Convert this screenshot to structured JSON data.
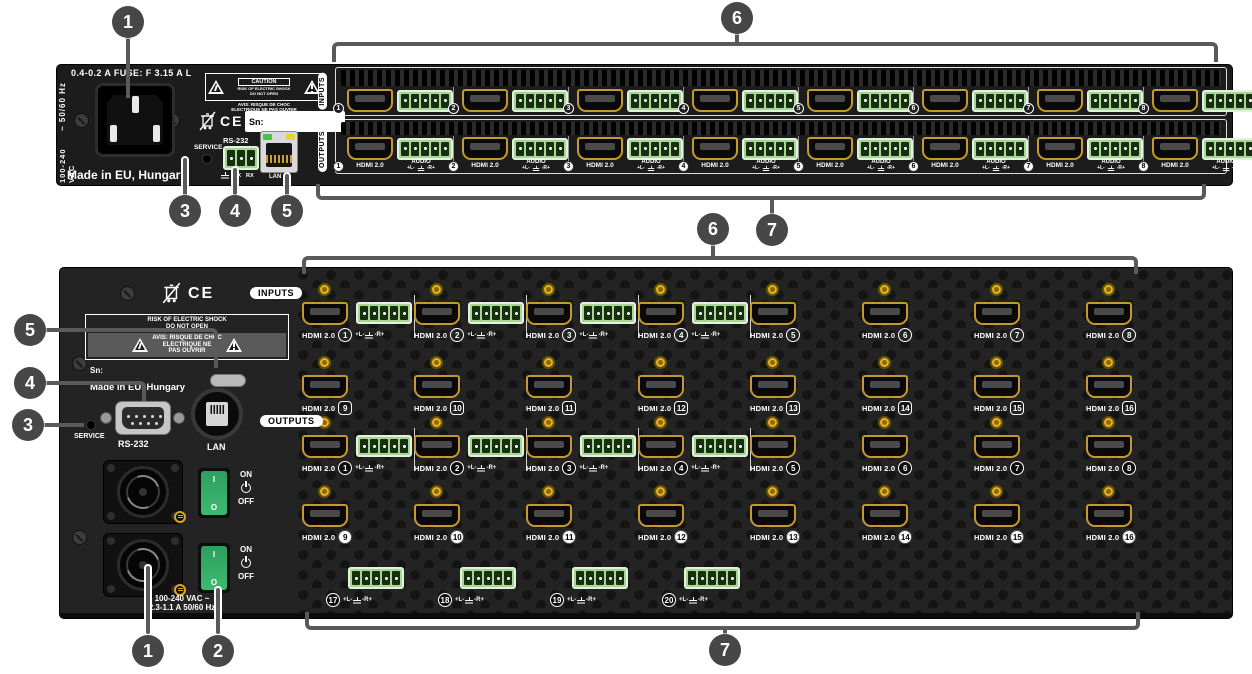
{
  "callouts": {
    "c1": "1",
    "c2": "2",
    "c3": "3",
    "c4": "4",
    "c5": "5",
    "c6": "6",
    "c7": "7"
  },
  "io": {
    "hdmi_label": "HDMI 2.0",
    "audio_label": "AUDIO",
    "pin_left": "+L-",
    "pin_right": "-R+"
  },
  "top_device": {
    "fuse_text": "0.4-0.2 A    FUSE: F 3.15 A L",
    "freq_text": "~ 50/60 Hz",
    "voltage_text": "100-240 VAC",
    "made_in_text": "Made in EU, Hungary",
    "caution_title": "CAUTION",
    "caution_line1": "RISK OF ELECTRIC SHOCK",
    "caution_line2": "DO NOT OPEN",
    "caution_avis1": "AVIS: RISQUE DE CHOC",
    "caution_avis2": "ELECTRIQUE NE PAS OUVRIR",
    "ce_mark": "CE",
    "sn_label": "Sn:",
    "service_label": "SERVICE",
    "rs232_label": "RS-232",
    "rs232_pin_tx": "TX",
    "rs232_pin_rx": "RX",
    "lan_label": "LAN",
    "inputs_label": "INPUTS",
    "outputs_label": "OUTPUTS",
    "input_numbers": [
      "1",
      "2",
      "3",
      "4",
      "5",
      "6",
      "7",
      "8"
    ],
    "output_numbers": [
      "1",
      "2",
      "3",
      "4",
      "5",
      "6",
      "7",
      "8"
    ]
  },
  "bottom_device": {
    "warning_line1": "RISK OF ELECTRIC SHOCK",
    "warning_line2": "DO NOT OPEN",
    "warning_avis1": "AVIS: RISQUE DE CHOC",
    "warning_avis2": "ELECTRIQUE NE",
    "warning_avis3": "PAS OUVRIR",
    "ce_mark": "CE",
    "sn_label": "Sn:",
    "made_in_text": "Made in EU, Hungary",
    "service_label": "SERVICE",
    "rs232_label": "RS-232",
    "lan_label": "LAN",
    "on_label": "ON",
    "off_label": "OFF",
    "rocker_on_symbol": "I",
    "rocker_off_symbol": "O",
    "power_text_line1": "100-240 VAC ~",
    "power_text_line2": "2.3-1.1 A  50/60 Hz",
    "inputs_label": "INPUTS",
    "outputs_label": "OUTPUTS",
    "input_rows": [
      [
        {
          "n": "1",
          "audio": true
        },
        {
          "n": "2",
          "audio": true
        },
        {
          "n": "3",
          "audio": true
        },
        {
          "n": "4",
          "audio": true
        },
        {
          "n": "5"
        },
        {
          "n": "6"
        },
        {
          "n": "7"
        },
        {
          "n": "8"
        }
      ],
      [
        {
          "n": "9"
        },
        {
          "n": "10"
        },
        {
          "n": "11"
        },
        {
          "n": "12"
        },
        {
          "n": "13"
        },
        {
          "n": "14"
        },
        {
          "n": "15"
        },
        {
          "n": "16"
        }
      ]
    ],
    "output_rows": [
      [
        {
          "n": "1",
          "audio": true
        },
        {
          "n": "2",
          "audio": true
        },
        {
          "n": "3",
          "audio": true
        },
        {
          "n": "4",
          "audio": true
        },
        {
          "n": "5"
        },
        {
          "n": "6"
        },
        {
          "n": "7"
        },
        {
          "n": "8"
        }
      ],
      [
        {
          "n": "9"
        },
        {
          "n": "10"
        },
        {
          "n": "11"
        },
        {
          "n": "12"
        },
        {
          "n": "13"
        },
        {
          "n": "14"
        },
        {
          "n": "15"
        },
        {
          "n": "16"
        }
      ]
    ],
    "audio_ports": [
      {
        "n": "17"
      },
      {
        "n": "18"
      },
      {
        "n": "19"
      },
      {
        "n": "20"
      }
    ]
  }
}
